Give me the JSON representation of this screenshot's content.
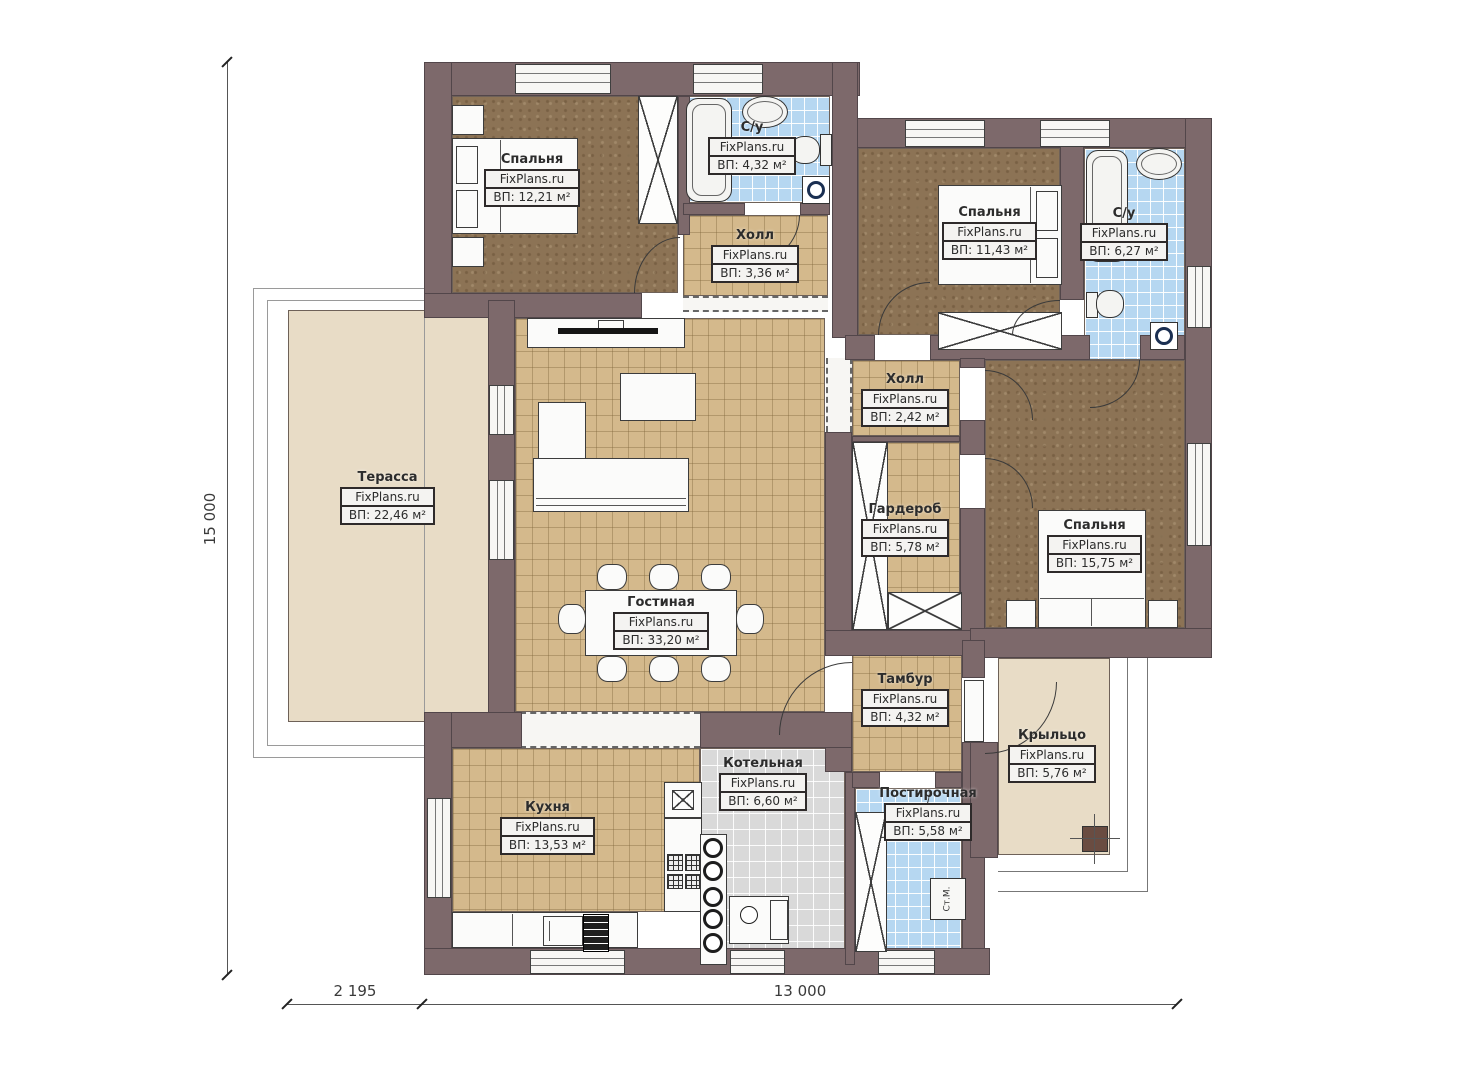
{
  "brand": "FixPlans.ru",
  "washer_label": "Ст.М.",
  "dimensions": {
    "left_total": "15 000",
    "bottom_left": "2 195",
    "bottom_right": "13 000"
  },
  "rooms": [
    {
      "id": "bedroom1",
      "name": "Спальня",
      "area": "ВП: 12,21 м²"
    },
    {
      "id": "bath1",
      "name": "С/у",
      "area": "ВП: 4,32 м²"
    },
    {
      "id": "hall1",
      "name": "Холл",
      "area": "ВП: 3,36 м²"
    },
    {
      "id": "bedroom2",
      "name": "Спальня",
      "area": "ВП: 11,43 м²"
    },
    {
      "id": "bath2",
      "name": "С/у",
      "area": "ВП: 6,27 м²"
    },
    {
      "id": "terrace",
      "name": "Терасса",
      "area": "ВП: 22,46 м²"
    },
    {
      "id": "hall2",
      "name": "Холл",
      "area": "ВП: 2,42 м²"
    },
    {
      "id": "wardrobe",
      "name": "Гардероб",
      "area": "ВП: 5,78 м²"
    },
    {
      "id": "bedroom3",
      "name": "Спальня",
      "area": "ВП: 15,75 м²"
    },
    {
      "id": "living",
      "name": "Гостиная",
      "area": "ВП: 33,20 м²"
    },
    {
      "id": "tambour",
      "name": "Тамбур",
      "area": "ВП: 4,32 м²"
    },
    {
      "id": "porch",
      "name": "Крыльцо",
      "area": "ВП: 5,76 м²"
    },
    {
      "id": "kitchen",
      "name": "Кухня",
      "area": "ВП: 13,53 м²"
    },
    {
      "id": "boiler",
      "name": "Котельная",
      "area": "ВП: 6,60 м²"
    },
    {
      "id": "laundry",
      "name": "Постирочная",
      "area": "ВП: 5,58 м²"
    }
  ],
  "colors": {
    "wall": "#7d696b",
    "floor_tile_tan": "#d4b98c",
    "floor_tile_blue": "#b6d7f1",
    "floor_tile_gray": "#d9d9d9",
    "floor_wood_dark": "#8c7355",
    "terrace_beige": "#e8dcc6",
    "label_box": "#f4f3f1"
  }
}
